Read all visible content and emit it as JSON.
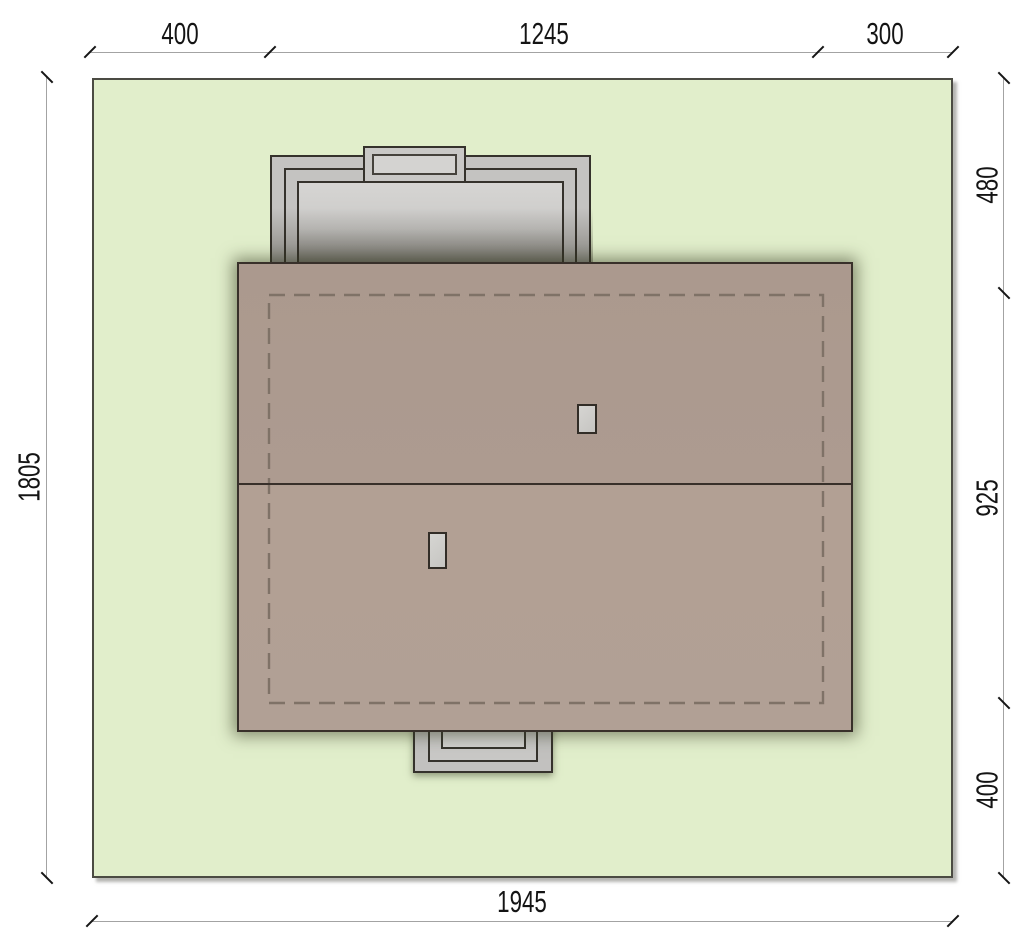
{
  "drawing": {
    "type": "architectural-site-plan",
    "plot": {
      "width_label": "1945",
      "height_label": "1805"
    },
    "dimensions": {
      "top": {
        "segments": [
          {
            "label": "400"
          },
          {
            "label": "1245"
          },
          {
            "label": "300"
          }
        ]
      },
      "right": {
        "segments": [
          {
            "label": "480"
          },
          {
            "label": "925"
          },
          {
            "label": "400"
          }
        ]
      },
      "bottom": {
        "segments": [
          {
            "label": "1945"
          }
        ]
      },
      "left": {
        "segments": [
          {
            "label": "1805"
          }
        ]
      }
    },
    "colors": {
      "plot_fill": "#e1eecb",
      "plot_border": "#4b4b43",
      "roof_fill_top": "#ab998e",
      "roof_fill_bottom": "#b1a095",
      "roof_border": "#38302a",
      "structure_fill": "#c4c3c1",
      "structure_fill_light": "#d4d3d1",
      "structure_border": "#35322c",
      "dashed_outline": "#7f7267",
      "dimension_line": "#a3a3a3",
      "dimension_text": "#141414"
    }
  }
}
